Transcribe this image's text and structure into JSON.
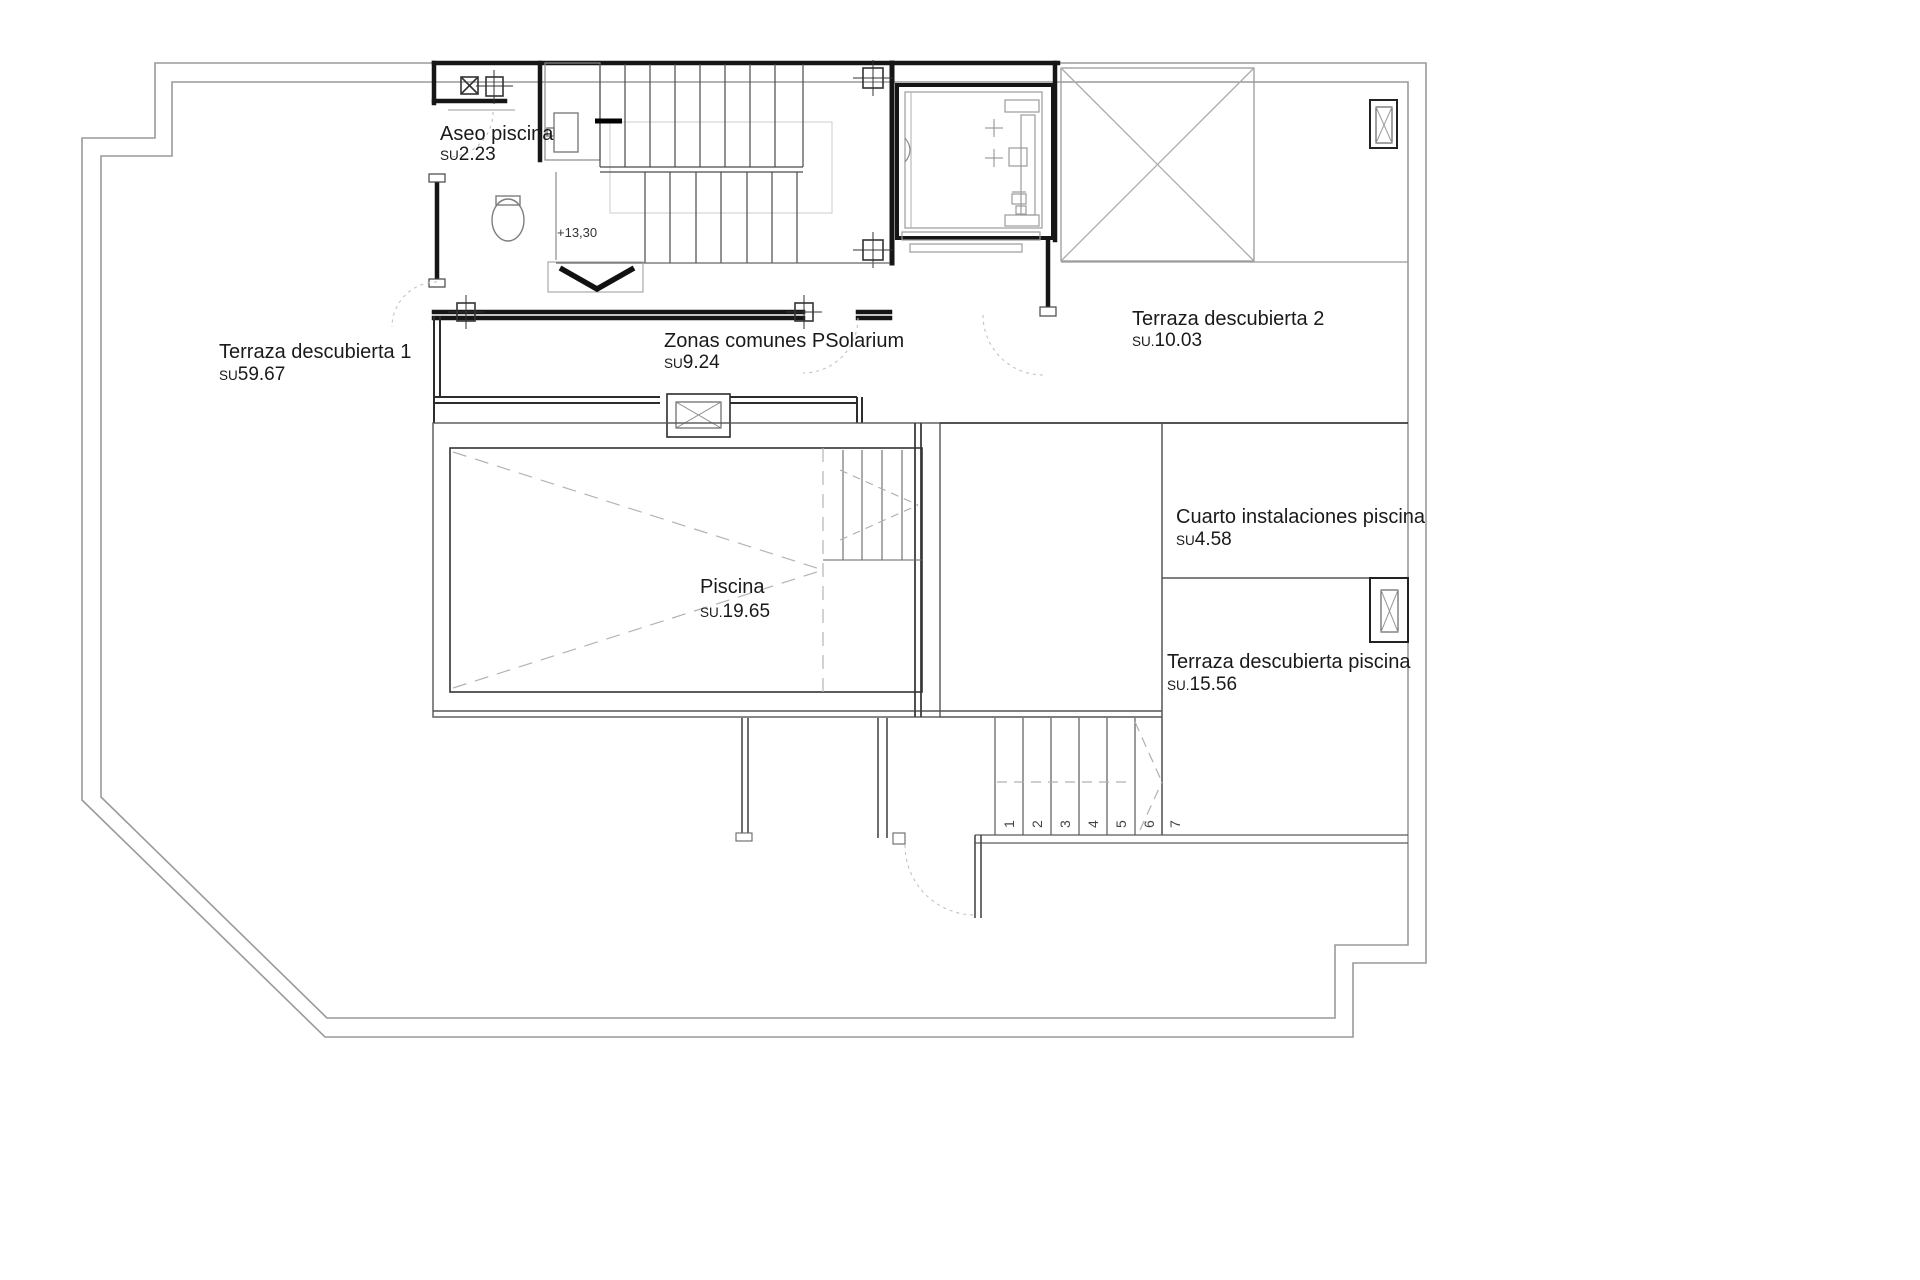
{
  "plan": {
    "type": "architectural-floor-plan",
    "labels": {
      "aseo": {
        "name": "Aseo piscina",
        "su": "SU",
        "area": "2.23"
      },
      "terraza1": {
        "name": "Terraza descubierta 1",
        "su": "SU",
        "area": "59.67"
      },
      "zonas": {
        "name": "Zonas comunes PSolarium",
        "su": "SU",
        "area": "9.24"
      },
      "terraza2": {
        "name": "Terraza descubierta 2",
        "su": "SU.",
        "area": "10.03"
      },
      "cuarto": {
        "name": "Cuarto instalaciones piscina",
        "su": "SU",
        "area": "4.58"
      },
      "piscina": {
        "name": "Piscina",
        "su": "SU.",
        "area": "19.65"
      },
      "terraza_piscina": {
        "name": "Terraza descubierta piscina",
        "su": "SU.",
        "area": "15.56"
      }
    },
    "annotations": {
      "level_mark": "+13,30",
      "stair_steps": [
        "1",
        "2",
        "3",
        "4",
        "5",
        "6",
        "7"
      ]
    },
    "colors": {
      "wall_dark": "#161616",
      "line_mid": "#555555",
      "line_gray": "#979797",
      "line_light": "#bdbdbd",
      "text": "#1a1a1a"
    }
  }
}
